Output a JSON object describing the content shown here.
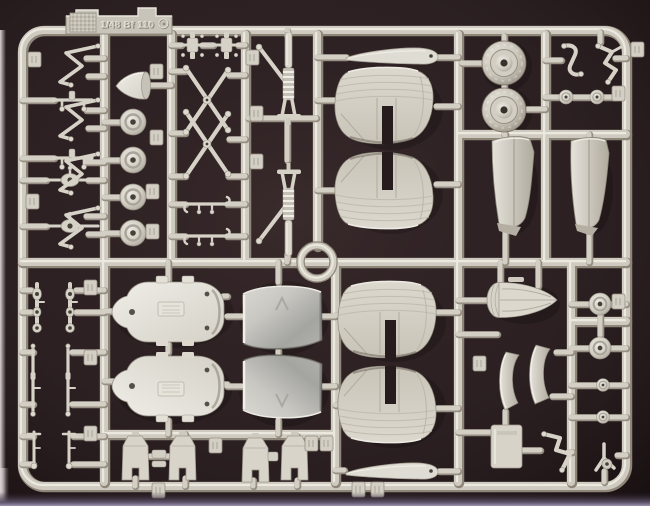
{
  "scene": {
    "description": "Photograph of a light grey injection-moulded plastic model-kit sprue (parts frame) lying on a dark brown background",
    "embossed_text": "1/48 Bf 110",
    "colors": {
      "background": "#2e2224",
      "background_edge": "#1c1415",
      "plastic": "#d6d2c8",
      "plastic_highlight": "#efede5",
      "plastic_shadow": "#a39d91",
      "photo_edge_left": "#d9d0d3",
      "photo_edge_bottom": "#9c92ac"
    },
    "parts": [
      "sprue-tab-with-kit-marking",
      "tailplane-panels",
      "wing-tip-blades",
      "main-wheel-hubs",
      "tyres",
      "spinner-cone",
      "oleo-struts",
      "cross-braces",
      "rudder-halves",
      "engine-bulkheads",
      "cowling-panels",
      "gear-door-boots",
      "gear-linkages",
      "ring-adapter",
      "tail-cone",
      "part-number-tags"
    ]
  }
}
